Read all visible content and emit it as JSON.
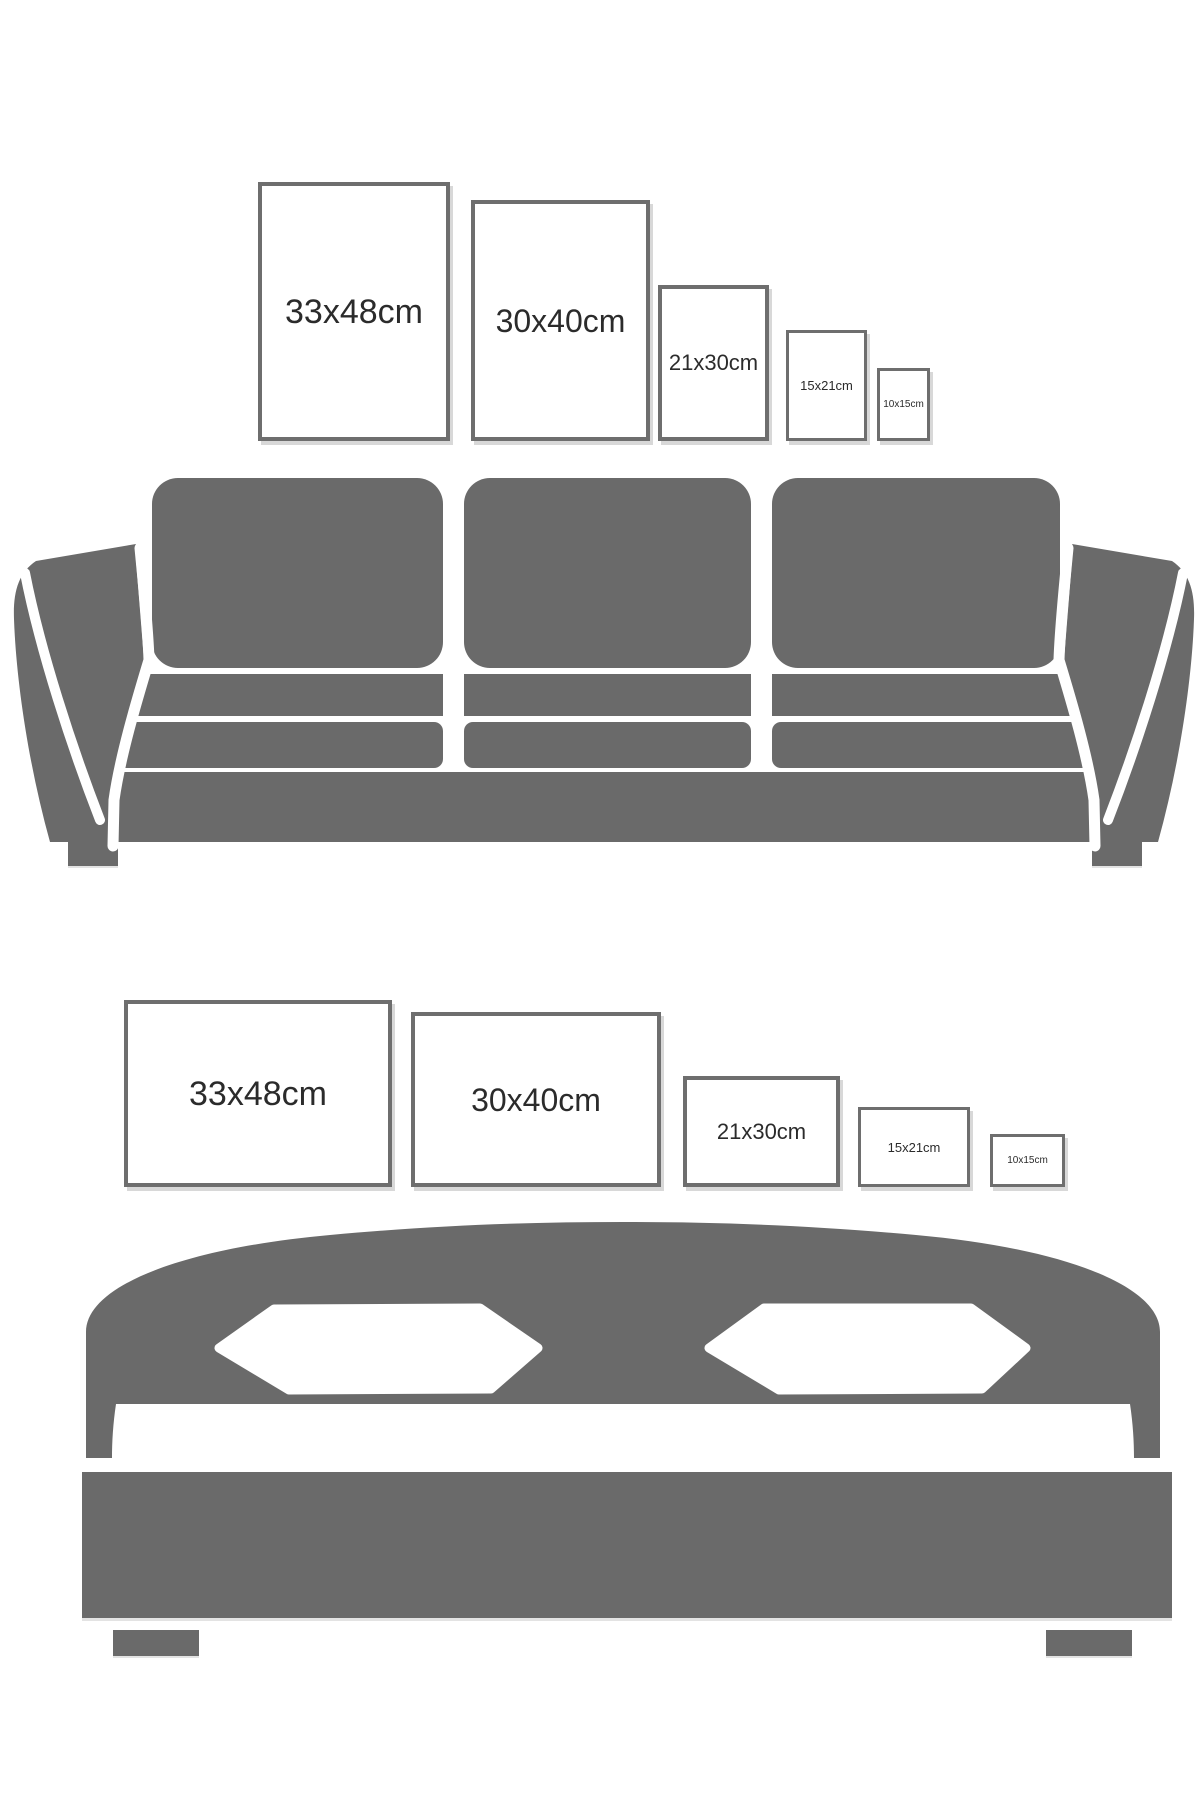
{
  "colors": {
    "furniture_gray": "#6a6a6a",
    "frame_border": "#6e6e6e",
    "label_text": "#2b2b2b",
    "shadow": "#d8d8d8"
  },
  "sections": [
    {
      "name": "sofa-wall",
      "furniture": "sofa",
      "frames": [
        {
          "label": "33x48cm",
          "orientation": "portrait"
        },
        {
          "label": "30x40cm",
          "orientation": "portrait"
        },
        {
          "label": "21x30cm",
          "orientation": "portrait"
        },
        {
          "label": "15x21cm",
          "orientation": "portrait"
        },
        {
          "label": "10x15cm",
          "orientation": "portrait"
        }
      ]
    },
    {
      "name": "bed-wall",
      "furniture": "bed",
      "frames": [
        {
          "label": "33x48cm",
          "orientation": "landscape"
        },
        {
          "label": "30x40cm",
          "orientation": "landscape"
        },
        {
          "label": "21x30cm",
          "orientation": "landscape"
        },
        {
          "label": "15x21cm",
          "orientation": "landscape"
        },
        {
          "label": "10x15cm",
          "orientation": "landscape"
        }
      ]
    }
  ]
}
